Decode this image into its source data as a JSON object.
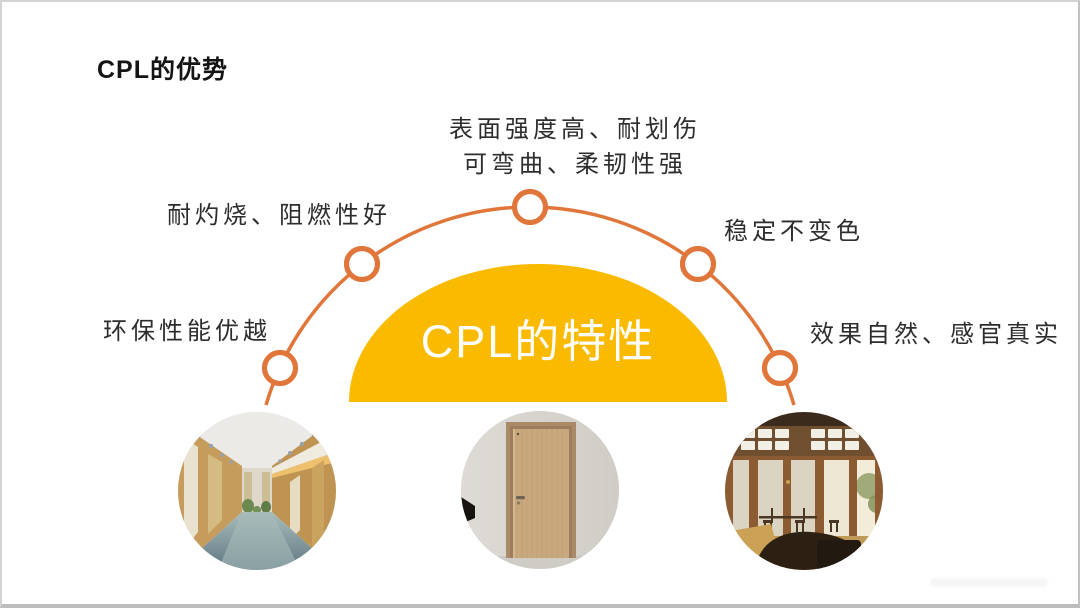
{
  "page": {
    "title": "CPL的优势"
  },
  "diagram": {
    "center_label": "CPL的特性",
    "arc_color": "#E0763A",
    "dome_color": "#F9BA00",
    "labels": {
      "top_line1": "表面强度高、耐划伤",
      "top_line2": "可弯曲、柔韧性强",
      "left_upper": "耐灼烧、阻燃性好",
      "right_upper": "稳定不变色",
      "left_lower": "环保性能优越",
      "right_lower": "效果自然、感官真实"
    },
    "node_count": 5
  },
  "photos": [
    {
      "id": "hallway"
    },
    {
      "id": "wood-door"
    },
    {
      "id": "glass-doors-room"
    }
  ]
}
